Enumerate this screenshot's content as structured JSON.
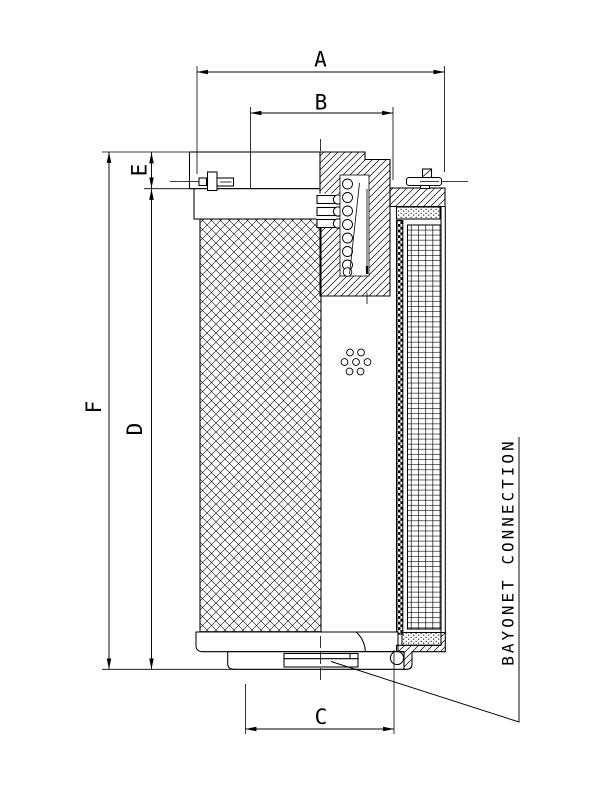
{
  "drawing": {
    "background_color": "#ffffff",
    "line_color": "#000000",
    "dimension_labels": {
      "a": "A",
      "b": "B",
      "c": "C",
      "d": "D",
      "e": "E",
      "f": "F"
    },
    "callout_label": "BAYONET CONNECTION"
  }
}
